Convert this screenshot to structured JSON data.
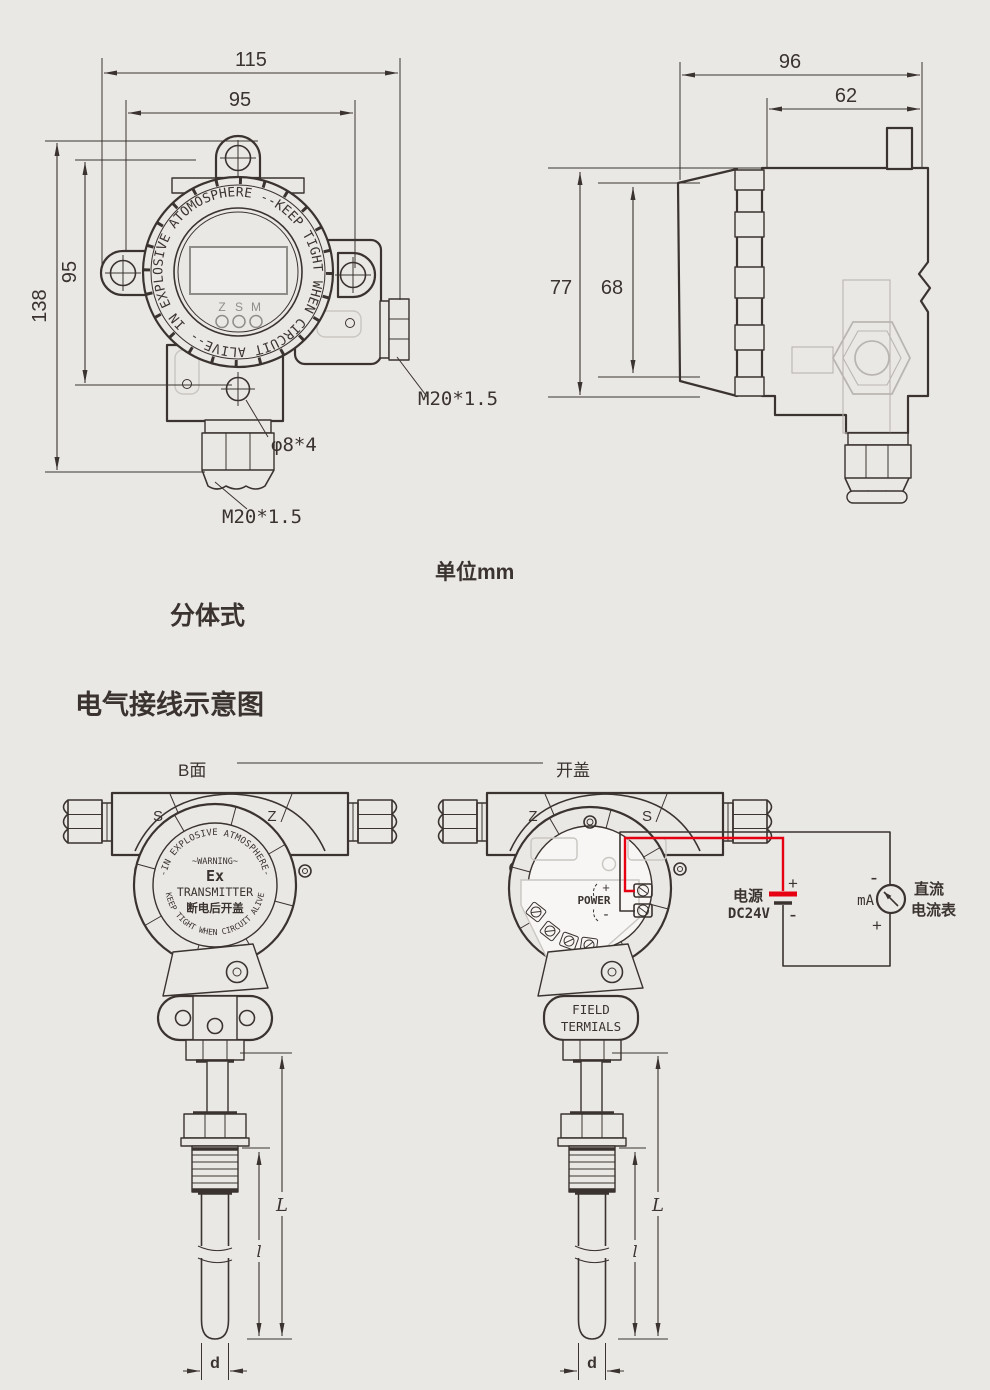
{
  "unit_note": "单位mm",
  "variant_label": "分体式",
  "section_title": "电气接线示意图",
  "front_view": {
    "dim_width_overall": "115",
    "dim_width_mount": "95",
    "dim_height_overall": "138",
    "dim_height_mount": "95",
    "ring_text": "IN EXPLOSIVE ATOMOSPHERE --KEEP TIGHT WHEN CIRCUIT ALIVE--",
    "key_z": "Z",
    "key_s": "S",
    "key_m": "M",
    "label_conduit": "M20*1.5",
    "label_holes": "φ8*4",
    "label_gland": "M20*1.5"
  },
  "side_view": {
    "dim_depth_overall": "96",
    "dim_depth_body": "62",
    "dim_height_overall": "77",
    "dim_height_cover": "68"
  },
  "wiring": {
    "label_b_face": "B面",
    "label_open_cover": "开盖",
    "b_face_device": {
      "mark_left": "S",
      "mark_right": "Z",
      "arc_top": "-IN EXPLOSIVE ATMOSPHERE-",
      "warning": "~WARNING~",
      "ex_mark": "Ex",
      "device_type": "TRANSMITTER",
      "caution_cn": "断电后开盖",
      "arc_bottom": "KEEP TIGHT WHEN CIRCUIT ALIVE"
    },
    "open_device": {
      "mark_left": "Z",
      "mark_right": "S",
      "power_label": "POWER",
      "power_plus": "+",
      "power_minus": "-",
      "plate_line1": "FIELD",
      "plate_line2": "TERMIALS"
    },
    "circuit": {
      "supply_label": "电源",
      "supply_value": "DC24V",
      "supply_plus": "+",
      "supply_minus": "-",
      "meter_minus": "-",
      "meter_plus": "+",
      "meter_unit": "mA",
      "meter_label_1": "直流",
      "meter_label_2": "电流表"
    },
    "probe": {
      "dim_total": "L",
      "dim_immersion": "l",
      "dim_diameter": "d"
    }
  },
  "colors": {
    "line": "#3a332f",
    "light": "#b9b6b2",
    "faint": "#c9c6c2",
    "gray": "#8f8d8a",
    "red": "#e60012",
    "bg": "#eae8e5",
    "white": "#f7f6f4",
    "lcd": "#edecea"
  }
}
